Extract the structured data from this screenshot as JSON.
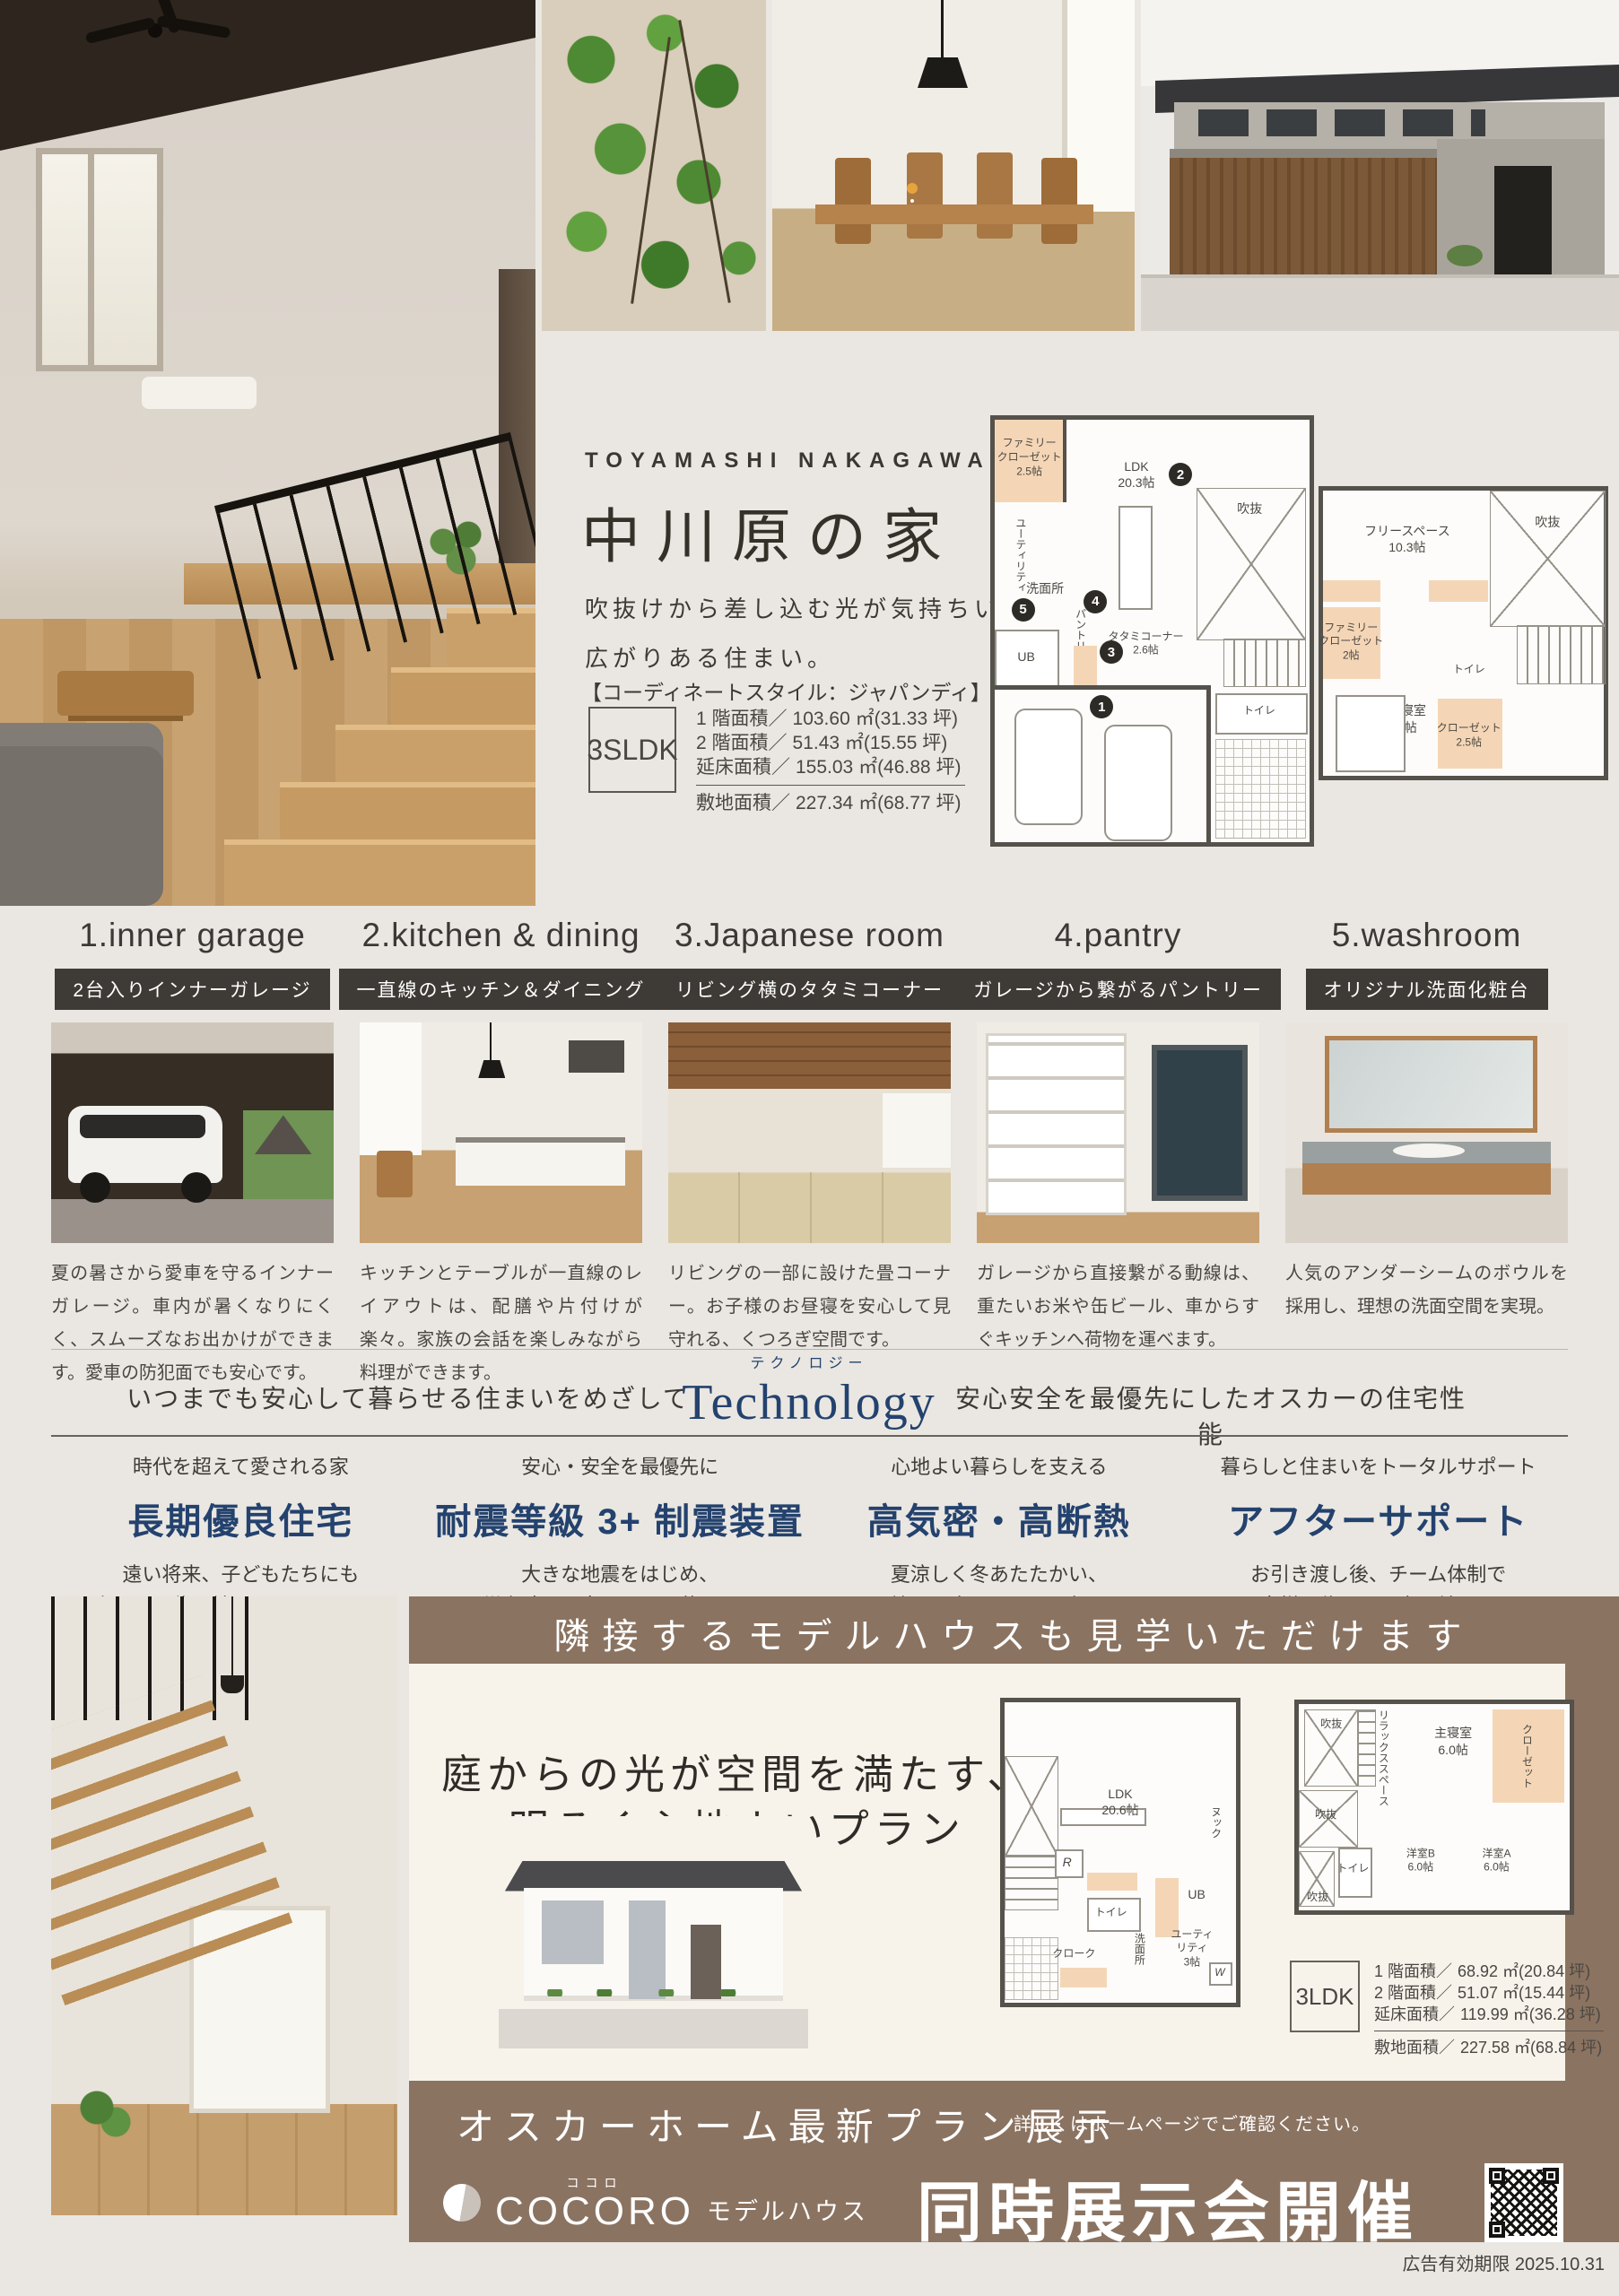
{
  "colors": {
    "page_bg": "#eae7e2",
    "navy": "#24426e",
    "brown": "#8b7361",
    "badge_bg": "#3e3a35",
    "cream": "#f7f3eb",
    "peach": "#f4d6b6",
    "wall": "#55514b"
  },
  "header": {
    "location_en": "TOYAMASHI NAKAGAWARA",
    "title": "中川原の家",
    "tagline": "吹抜けから差し込む光が気持ちいい、\n広がりある住まい。",
    "style_label": "【コーディネートスタイル：ジャパンディ】",
    "plan_type": "3SLDK",
    "area_rows": [
      {
        "label": "1 階面積／",
        "value": "103.60 ㎡(31.33 坪)"
      },
      {
        "label": "2 階面積／",
        "value": "51.43 ㎡(15.55 坪)"
      },
      {
        "label": "延床面積／",
        "value": "155.03 ㎡(46.88 坪)"
      }
    ],
    "site_row": {
      "label": "敷地面積／",
      "value": "227.34 ㎡(68.77 坪)"
    }
  },
  "features": [
    {
      "title": "1.inner garage",
      "badge": "2台入りインナーガレージ",
      "desc": "夏の暑さから愛車を守るインナーガレージ。車内が暑くなりにくく、スムーズなお出かけができます。愛車の防犯面でも安心です。"
    },
    {
      "title": "2.kitchen & dining",
      "badge": "一直線のキッチン＆ダイニング",
      "desc": "キッチンとテーブルが一直線のレイアウトは、配膳や片付けが楽々。家族の会話を楽しみながら料理ができます。"
    },
    {
      "title": "3.Japanese room",
      "badge": "リビング横のタタミコーナー",
      "desc": "リビングの一部に設けた畳コーナー。お子様のお昼寝を安心して見守れる、くつろぎ空間です。"
    },
    {
      "title": "4.pantry",
      "badge": "ガレージから繋がるパントリー",
      "desc": "ガレージから直接繋がる動線は、重たいお米や缶ビール、車からすぐキッチンへ荷物を運べます。"
    },
    {
      "title": "5.washroom",
      "badge": "オリジナル洗面化粧台",
      "desc": "人気のアンダーシームのボウルを採用し、理想の洗面空間を実現。"
    }
  ],
  "technology": {
    "left_text": "いつまでも安心して暮らせる住まいをめざして",
    "ruby": "テクノロジー",
    "title": "Technology",
    "right_text": "安心安全を最優先にしたオスカーの住宅性能",
    "items": [
      {
        "lead": "時代を超えて愛される家",
        "title": "長期優良住宅",
        "desc": "遠い将来、子どもたちにも\n安心して住み続けてもらうために"
      },
      {
        "lead": "安心・安全を最優先に",
        "title": "耐震等級 3+ 制震装置",
        "desc": "大きな地震をはじめ、\n災害時でも変わりない暮らしを"
      },
      {
        "lead": "心地よい暮らしを支える",
        "title": "高気密・高断熱",
        "desc": "夏涼しく冬あたたかい、\n環境に配慮したエコな毎日を"
      },
      {
        "lead": "暮らしと住まいをトータルサポート",
        "title": "アフターサポート",
        "desc": "お引き渡し後、チーム体制で\nお客様の住まいを守り続けます"
      }
    ]
  },
  "model_house": {
    "banner": "隣接するモデルハウスも見学いただけます",
    "catch_l1": "庭からの光が空間を満たす、",
    "catch_l2": "明るく心地よいプラン",
    "plan_type": "3LDK",
    "area_rows": [
      {
        "label": "1 階面積／",
        "value": "68.92 ㎡(20.84 坪)"
      },
      {
        "label": "2 階面積／",
        "value": "51.07 ㎡(15.44 坪)"
      },
      {
        "label": "延床面積／",
        "value": "119.99 ㎡(36.28 坪)"
      }
    ],
    "site_row": {
      "label": "敷地面積／",
      "value": "227.58 ㎡(68.84 坪)"
    }
  },
  "footer": {
    "headline": "オスカーホーム最新プラン展示",
    "note": "詳しくはホームページでご確認ください。",
    "brand_ruby": "ココロ",
    "brand": "COCORO",
    "brand_suffix": "モデルハウス",
    "event": "同時展示会開催",
    "validity": "広告有効期限 2025.10.31"
  },
  "plans": {
    "m1f": {
      "fc": "ファミリー\nクローゼット\n2.5帖",
      "ldk": "LDK\n20.3帖",
      "void": "吹抜",
      "utility": "ユーティリティ",
      "senmen": "洗面所",
      "pantry": "パントリー",
      "ub": "UB",
      "tatami": "タタミコーナー\n2.6帖",
      "toilet": "トイレ",
      "n1": "1",
      "n2": "2",
      "n3": "3",
      "n4": "4",
      "n5": "5"
    },
    "m2f": {
      "free": "フリースペース\n10.3帖",
      "void": "吹抜",
      "fc": "ファミリー\nクローゼット\n2帖",
      "master": "主寝室\n8帖",
      "toilet": "トイレ",
      "closet": "クローゼット\n2.5帖"
    },
    "b1f": {
      "ldk": "LDK\n20.6帖",
      "nook": "ヌック",
      "r": "R",
      "ub": "UB",
      "toilet": "トイレ",
      "cloak": "クローク",
      "senmen": "洗面所",
      "utility": "ユーティリティ\n3帖",
      "w": "W"
    },
    "b2f": {
      "void1": "吹抜",
      "relax": "リラックススペース",
      "master": "主寝室\n6.0帖",
      "closet": "クローゼット",
      "void2": "吹抜",
      "toilet": "トイレ",
      "room_b": "洋室B\n6.0帖",
      "room_a": "洋室A\n6.0帖",
      "void3": "吹抜"
    }
  }
}
